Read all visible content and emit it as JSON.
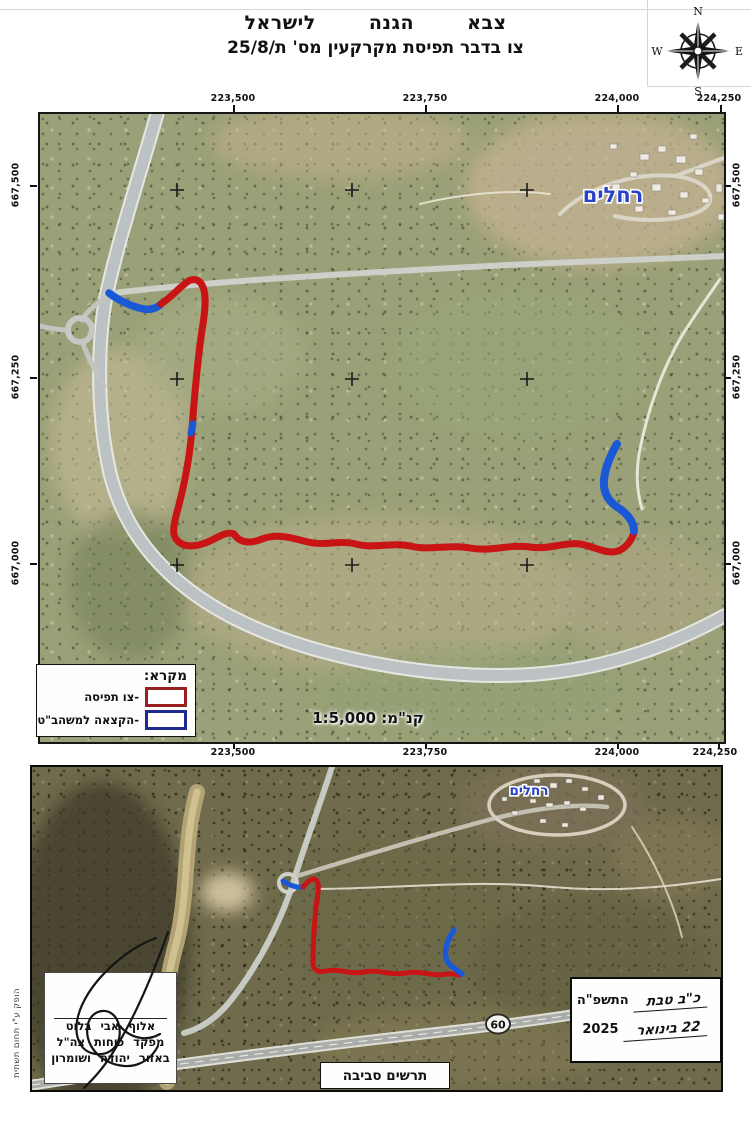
{
  "header": {
    "title_line1": "צבא הגנה לישראל",
    "title_line2_prefix": "צו בדבר תפיסת מקרקעין מס' ",
    "order_number": "25/8/ת"
  },
  "compass": {
    "n": "N",
    "e": "E",
    "s": "S",
    "w": "W"
  },
  "main_map": {
    "top_coords": [
      "223,500",
      "223,750",
      "224,000",
      "224,250"
    ],
    "bottom_coords": [
      "223,500",
      "223,750",
      "224,000",
      "224,250"
    ],
    "left_coords": [
      "667,500",
      "667,250",
      "667,000"
    ],
    "right_coords": [
      "667,500",
      "667,250",
      "667,000"
    ],
    "settlement_label": "רחלים",
    "scale_text": "קנ\"מ: 1:5,000",
    "legend": {
      "title": "מקרא:",
      "items": [
        {
          "label": "-צו תפיסה",
          "color": "#9a1f1f"
        },
        {
          "label": "-הקצאה למשהב\"ט",
          "color": "#1f2a8f"
        }
      ]
    }
  },
  "overview_map": {
    "settlement_label": "רחלים",
    "road_label": "60",
    "caption": "תרשים סביבה"
  },
  "signature_block": {
    "line1": "אלוף אבי בלוט",
    "line2": "מפקד כוחות צה\"ל",
    "line3": "באזור יהודה ושומרון"
  },
  "date_block": {
    "hebrew_date_handwritten": "כ\"ב טבת",
    "hebrew_year_printed": "התשפ\"ה",
    "greg_date_handwritten": "22 בינואר",
    "greg_year_printed": "2025"
  },
  "footer": {
    "produced_by": "הופק ע\"י תחום תשתית"
  },
  "colors": {
    "seizure_red": "#c81414",
    "allocation_blue": "#1a58d6"
  }
}
